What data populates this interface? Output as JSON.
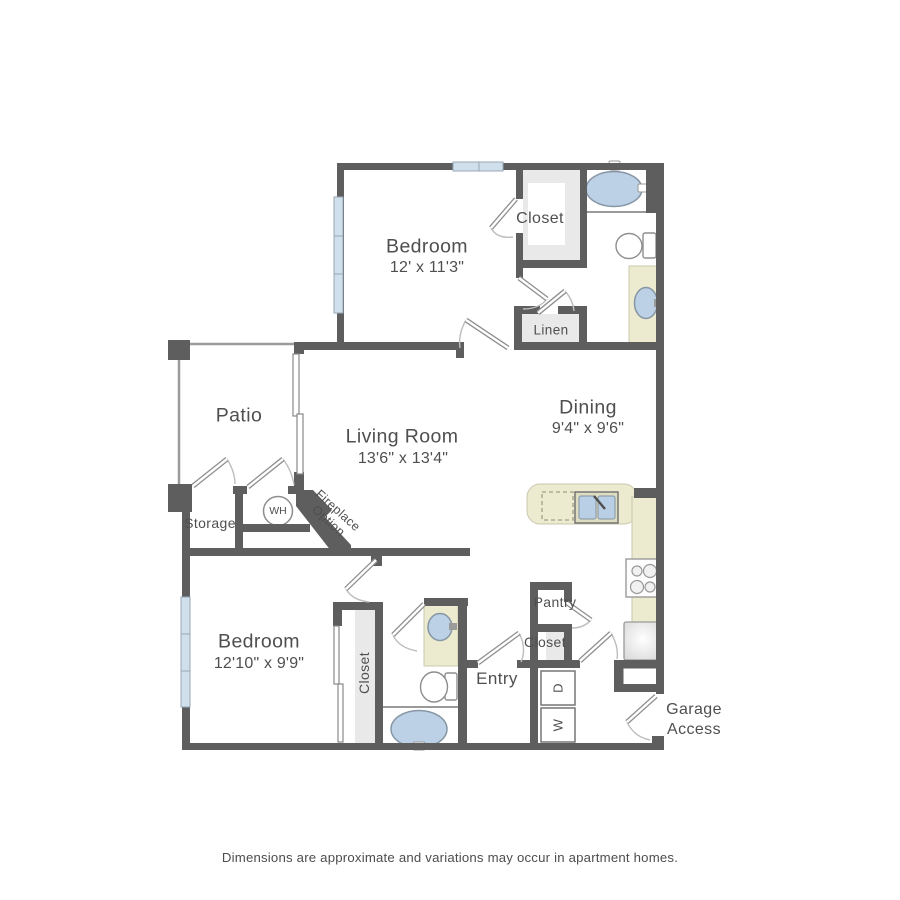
{
  "floor_plan": {
    "rooms": {
      "bedroom_1": {
        "name": "Bedroom",
        "dimensions": "12' x 11'3\""
      },
      "living_room": {
        "name": "Living Room",
        "dimensions": "13'6\" x 13'4\""
      },
      "dining_room": {
        "name": "Dining",
        "dimensions": "9'4\" x 9'6\""
      },
      "bedroom_2": {
        "name": "Bedroom",
        "dimensions": "12'10\" x 9'9\""
      },
      "patio": {
        "name": "Patio"
      },
      "storage": {
        "name": "Storage"
      },
      "pantry": {
        "name": "Pantry"
      },
      "entry": {
        "name": "Entry"
      }
    },
    "labels": {
      "bedroom_1_closet": "Closet",
      "linen": "Linen",
      "bedroom_2_closet": "Closet",
      "entry_closet": "Closet",
      "water_heater": "WH",
      "fireplace_line_1": "Fireplace",
      "fireplace_line_2": "Option",
      "dryer": "D",
      "washer": "W",
      "garage_line_1": "Garage",
      "garage_line_2": "Access"
    },
    "colors": {
      "wall": "#5e5e5e",
      "fixture_blue": "#bcd1e6",
      "counter_beige": "#eceacf",
      "window_blue": "#cfdfeb",
      "interior_gray": "#e9e9e9",
      "text": "#4f4f4f"
    }
  },
  "footer": {
    "disclaimer": "Dimensions are approximate and variations may occur in apartment homes."
  }
}
